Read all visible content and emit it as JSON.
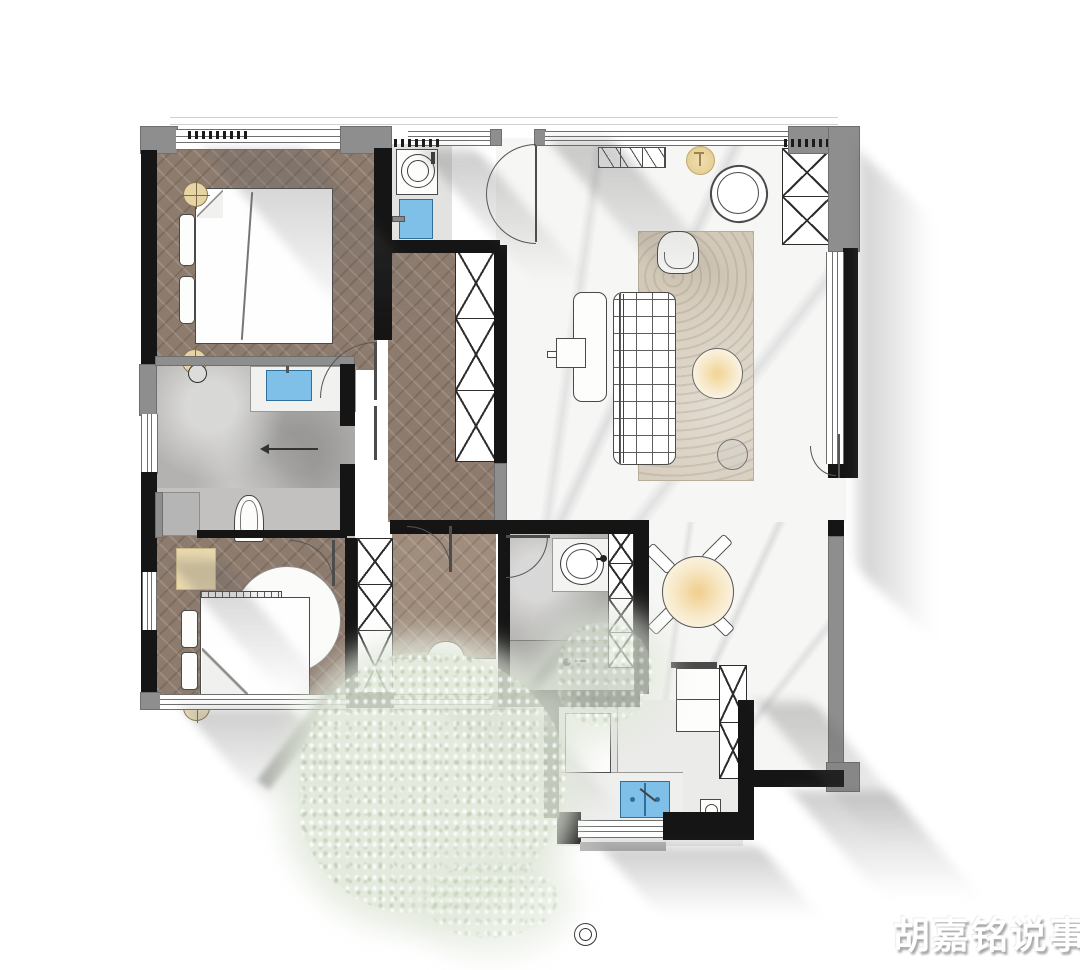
{
  "watermark": {
    "text": "胡嘉铭说事"
  },
  "palette": {
    "wall": "#151515",
    "concrete_column": "#8e8e8e",
    "wood_floor": "#8d7b6e",
    "wood_floor_light": "#a08d7d",
    "marble_floor": "#f6f6f4",
    "bath_tile": "#b3b2b0",
    "kitchen_floor": "#ebebe9",
    "sink_blue": "#7fc0e8",
    "lamp_warm": "#ecd7a4",
    "rug_tan": "#d3c9b8",
    "foliage_green": "#dfe7d8",
    "shadow_gray": "#646464"
  },
  "floorplan": {
    "type": "residential-apartment-top-view",
    "rooms": [
      {
        "id": "master-bedroom",
        "floor": "herringbone-wood",
        "furniture": [
          "double-bed",
          "duvet-fold",
          "headboard-cushions",
          "bedside-lamp-top",
          "bedside-lamp-bottom",
          "strip-window-top"
        ]
      },
      {
        "id": "laundry-nook",
        "floor": "light-gray",
        "furniture": [
          "washing-machine",
          "utility-sink-blue"
        ]
      },
      {
        "id": "entry",
        "furniture": [
          "double-entry-door",
          "shoe-cabinet",
          "round-stool",
          "fan-lounge-chair"
        ]
      },
      {
        "id": "living-room",
        "floor": "marble",
        "furniture": [
          "grid-sofa",
          "area-rug",
          "armchair",
          "round-coffee-table",
          "small-side-table",
          "console-desk",
          "tv-square",
          "wardrobe-x2",
          "window-wall-right",
          "curtain"
        ]
      },
      {
        "id": "hallway",
        "floor": "herringbone-wood",
        "furniture": [
          "tall-wardrobe-x3"
        ]
      },
      {
        "id": "master-bathroom",
        "floor": "gray-tile",
        "furniture": [
          "shower-head",
          "vanity-counter",
          "sink-blue",
          "toilet",
          "towel-rail"
        ]
      },
      {
        "id": "closet-strip",
        "furniture": [
          "hanging-clothes-wardrobe"
        ]
      },
      {
        "id": "bedroom-2",
        "floor": "herringbone-wood",
        "furniture": [
          "single-bed",
          "headboard-cushions",
          "round-rug",
          "lamp-table",
          "wardrobe-x3",
          "window-left",
          "window-bottom"
        ]
      },
      {
        "id": "study",
        "floor": "herringbone-wood-light",
        "furniture": [
          "built-in-desk",
          "half-round-chair",
          "window-bottom",
          "door"
        ]
      },
      {
        "id": "bathroom-2",
        "floor": "gray-tile",
        "furniture": [
          "round-sink",
          "toilet",
          "shower-zone",
          "floor-drain",
          "linen-cabinet-x4",
          "door"
        ]
      },
      {
        "id": "dining-area",
        "floor": "marble",
        "furniture": [
          "round-dining-table",
          "dining-chair-1",
          "dining-chair-2",
          "dining-chair-3",
          "dining-chair-4",
          "pendant-glow"
        ]
      },
      {
        "id": "kitchen",
        "floor": "light-gray",
        "furniture": [
          "gas-stove-two-burners",
          "counter-left",
          "counter-bottom",
          "double-sink-blue",
          "floor-drain-box",
          "refrigerator",
          "tall-cabinet-x2",
          "window-bottom"
        ]
      }
    ],
    "environment": [
      "cast-shadows-45deg",
      "tree-foliage-bottom-center",
      "embossed-watermark-bottom-right"
    ]
  }
}
